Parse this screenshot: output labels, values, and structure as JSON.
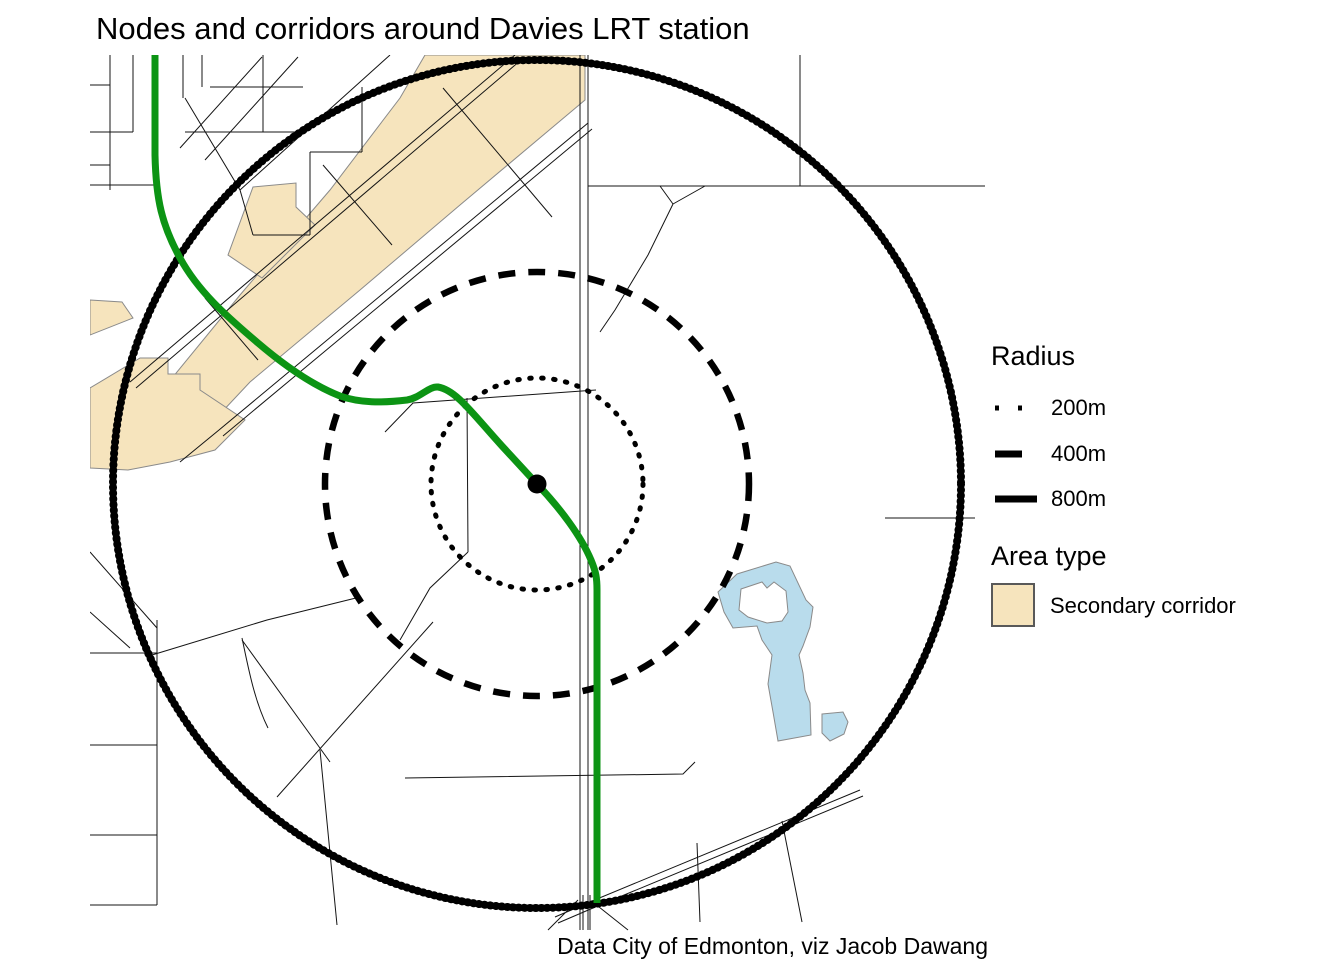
{
  "title": "Nodes and corridors around Davies LRT station",
  "caption": "Data City of Edmonton, viz Jacob Dawang",
  "legend": {
    "radius": {
      "title": "Radius",
      "items": [
        {
          "label": "200m",
          "style": "dotted"
        },
        {
          "label": "400m",
          "style": "dashed"
        },
        {
          "label": "800m",
          "style": "solid"
        }
      ]
    },
    "area": {
      "title": "Area type",
      "items": [
        {
          "label": "Secondary corridor",
          "swatch": "#f6e4bd"
        }
      ]
    }
  },
  "colors": {
    "lrt_green": "#0c9414",
    "corridor_fill": "#f6e4bd",
    "corridor_stroke": "#8a8a8a",
    "water_fill": "#b9dcec",
    "water_stroke": "#8a8a8a",
    "ring": "#000000",
    "street": "#141414",
    "text": "#000000",
    "swatch_border": "#595959",
    "background": "#ffffff"
  }
}
